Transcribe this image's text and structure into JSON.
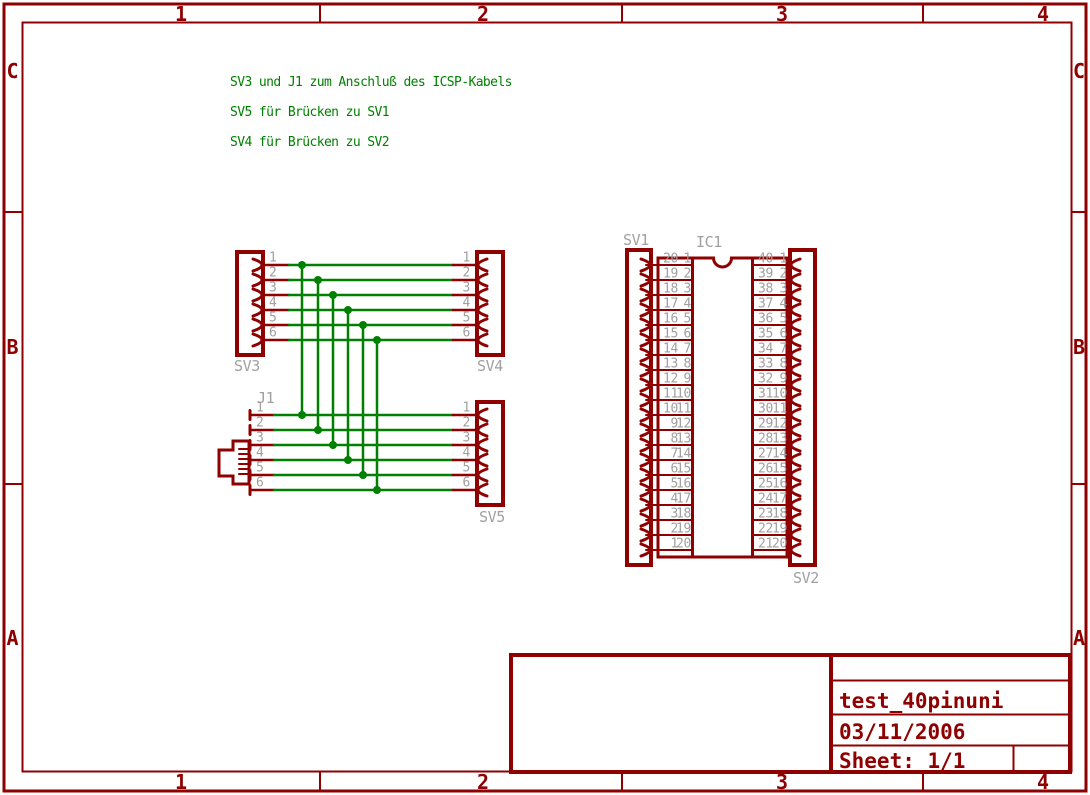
{
  "colors": {
    "outline": "#8F0000",
    "net": "#008000",
    "label": "#A0A0A0",
    "background": "#FFFFFF"
  },
  "frame": {
    "column_labels": [
      "1",
      "2",
      "3",
      "4"
    ],
    "row_labels": [
      "C",
      "B",
      "A"
    ]
  },
  "notes": {
    "line1": "SV3 und J1 zum Anschluß des ICSP-Kabels",
    "line2": "SV5 für Brücken zu SV1",
    "line3": "SV4 für Brücken zu SV2"
  },
  "title_block": {
    "title": "test_40pinuni",
    "date": "03/11/2006",
    "sheet": "Sheet: 1/1"
  },
  "connectors": {
    "sv3": {
      "name": "SV3",
      "pins": [
        "1",
        "2",
        "3",
        "4",
        "5",
        "6"
      ]
    },
    "sv4": {
      "name": "SV4",
      "pins": [
        "1",
        "2",
        "3",
        "4",
        "5",
        "6"
      ]
    },
    "sv5": {
      "name": "SV5",
      "pins": [
        "1",
        "2",
        "3",
        "4",
        "5",
        "6"
      ]
    },
    "j1": {
      "name": "J1",
      "pins": [
        "1",
        "2",
        "3",
        "4",
        "5",
        "6"
      ]
    },
    "sv1": {
      "name": "SV1"
    },
    "sv2": {
      "name": "SV2"
    },
    "ic1": {
      "name": "IC1"
    }
  },
  "ic_table": {
    "left_rows": [
      [
        "20",
        "1"
      ],
      [
        "19",
        "2"
      ],
      [
        "18",
        "3"
      ],
      [
        "17",
        "4"
      ],
      [
        "16",
        "5"
      ],
      [
        "15",
        "6"
      ],
      [
        "14",
        "7"
      ],
      [
        "13",
        "8"
      ],
      [
        "12",
        "9"
      ],
      [
        "11",
        "10"
      ],
      [
        "10",
        "11"
      ],
      [
        "9",
        "12"
      ],
      [
        "8",
        "13"
      ],
      [
        "7",
        "14"
      ],
      [
        "6",
        "15"
      ],
      [
        "5",
        "16"
      ],
      [
        "4",
        "17"
      ],
      [
        "3",
        "18"
      ],
      [
        "2",
        "19"
      ],
      [
        "1",
        "20"
      ]
    ],
    "right_rows": [
      [
        "40",
        "1"
      ],
      [
        "39",
        "2"
      ],
      [
        "38",
        "3"
      ],
      [
        "37",
        "4"
      ],
      [
        "36",
        "5"
      ],
      [
        "35",
        "6"
      ],
      [
        "34",
        "7"
      ],
      [
        "33",
        "8"
      ],
      [
        "32",
        "9"
      ],
      [
        "31",
        "10"
      ],
      [
        "30",
        "11"
      ],
      [
        "29",
        "12"
      ],
      [
        "28",
        "13"
      ],
      [
        "27",
        "14"
      ],
      [
        "26",
        "15"
      ],
      [
        "25",
        "16"
      ],
      [
        "24",
        "17"
      ],
      [
        "23",
        "18"
      ],
      [
        "22",
        "19"
      ],
      [
        "21",
        "20"
      ]
    ]
  }
}
